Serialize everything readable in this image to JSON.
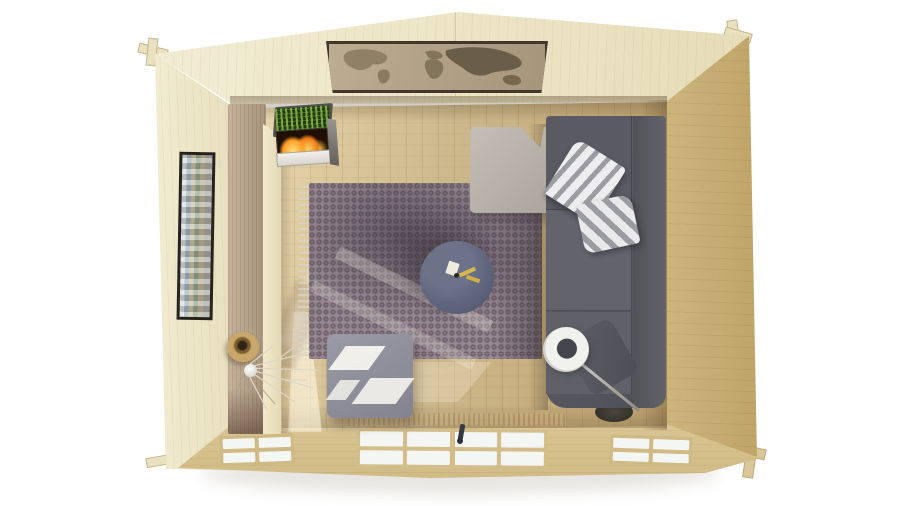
{
  "canvas": {
    "width": 900,
    "height": 506
  },
  "scene": {
    "type": "3d-render",
    "view": "top-down-interior",
    "subject": "log cabin living room seen from directly above",
    "objects": [
      {
        "name": "top-wall-with-world-map-art"
      },
      {
        "name": "left-wall-with-gallery-picture"
      },
      {
        "name": "right-wall"
      },
      {
        "name": "front-wall-with-door-and-windows"
      },
      {
        "name": "corner-log-joints",
        "count": 4
      },
      {
        "name": "electric-fireplace-with-flames"
      },
      {
        "name": "tall-wooden-cabinet"
      },
      {
        "name": "patterned-area-rug-with-fringe"
      },
      {
        "name": "round-coffee-table-with-small-items"
      },
      {
        "name": "corner-sofa"
      },
      {
        "name": "armchair"
      },
      {
        "name": "striped-pillow",
        "count": 2
      },
      {
        "name": "lumbar-cushion"
      },
      {
        "name": "arc-floor-lamp"
      },
      {
        "name": "square-ottoman-with-sunlight-patches"
      },
      {
        "name": "wicker-basket"
      },
      {
        "name": "dry-branches-decor"
      },
      {
        "name": "double-glass-door-with-handle"
      },
      {
        "name": "front-window-left"
      },
      {
        "name": "front-window-right"
      }
    ]
  },
  "palette": {
    "bg": "#ffffff",
    "wall-top": "#f2ecd4",
    "wall-light": "#f2ecd2",
    "wall-right": "#cdb67d",
    "wall-bottom": "#dcc795",
    "floor-light": "#eee0ba",
    "floor-mid": "#cdb88c",
    "floor-dark": "#bfa470",
    "rug": "#968790",
    "rug-shadow": "#37303a",
    "table": "#596077",
    "sofa": "#595a61",
    "armchair": "#a9a49b",
    "ottoman": "#82838f",
    "pillow-light": "#ededef",
    "pillow-dark": "#9c9ca3",
    "lamp-shade": "#f1f1ee",
    "flame": "#ffc94e",
    "fireplace-green": "#233c18",
    "basket": "#c9a76a",
    "cabinet-top": "#c6b39b",
    "map-frame": "#43362a",
    "map-paper": "#b3a38a",
    "map-land": "#7e7158",
    "pane": "#f4f6f3"
  }
}
